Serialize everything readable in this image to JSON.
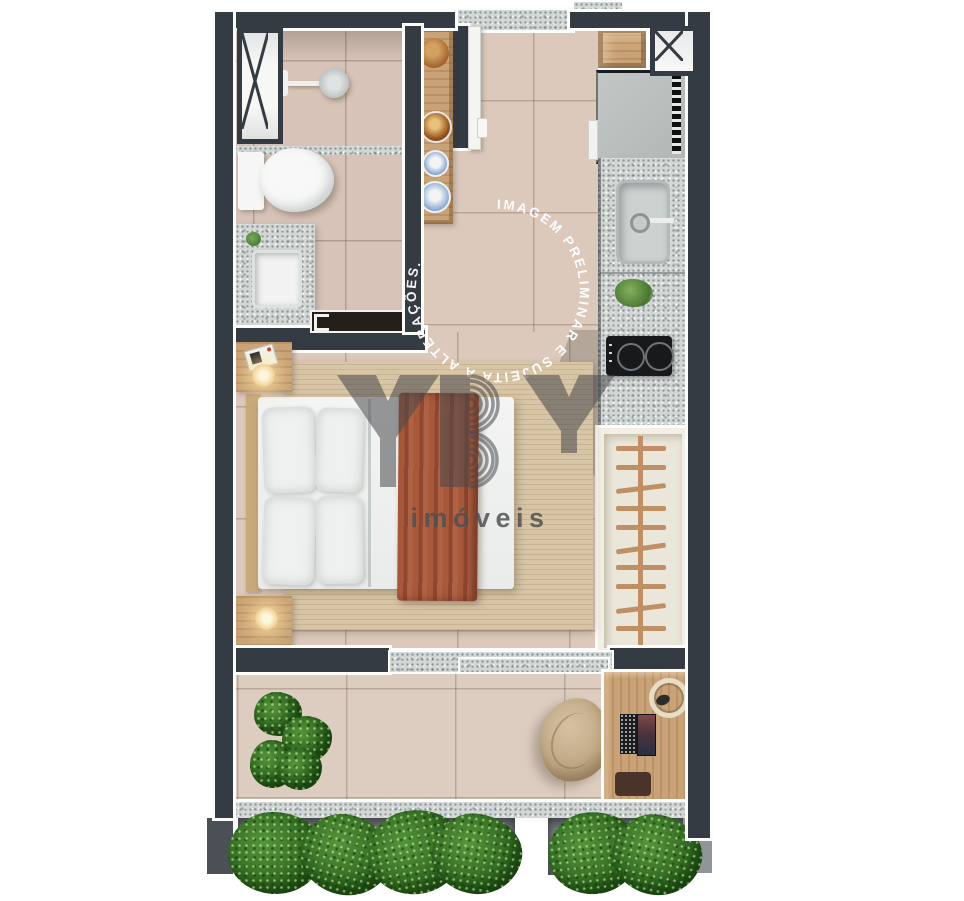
{
  "watermark": {
    "circle_text": "IMAGEM PRELIMINAR E SUJEITA A ALTERAÇÕES.  ",
    "text_color": "#ffffff"
  },
  "logo": {
    "name": "YBY",
    "tagline": "imóveis",
    "color": "#47474b"
  },
  "palette": {
    "wall": "#343b43",
    "wall_trim": "#fcfcfb",
    "floor_living": "#dcc9bc",
    "floor_bathroom": "#d7c3b7",
    "floor_balcony": "#ddcdc0",
    "granite_counter": "#d2d7d6",
    "wood": "#c9a377",
    "wardrobe_interior": "#ebe6da",
    "fridge": "#b9bdbc",
    "cooktop": "#17191b",
    "bed_linen": "#f1f3f2",
    "rug": "#d8c5a6",
    "throw_terracotta": "#a8593c",
    "greenery": "#2d651f",
    "planter_box": "#75797e"
  },
  "furniture_icons": [
    "duct-shaft-x-icon",
    "shower-head-icon",
    "toilet-icon",
    "vanity-sink-icon",
    "decor-shelf-bowls-icon",
    "entry-door-icon",
    "storage-box-icon",
    "fridge-icon",
    "kitchen-sink-icon",
    "herbs-icon",
    "cooktop-icon",
    "wardrobe-hangers-icon",
    "double-bed-icon",
    "pillow-icon",
    "throw-blanket-icon",
    "nightstand-icon",
    "radio-clock-icon",
    "lamp-icon",
    "rug-icon",
    "sliding-door-icon",
    "potted-plant-icon",
    "beanbag-icon",
    "desk-icon",
    "laptop-icon",
    "headphones-icon",
    "desk-pad-icon",
    "hedge-planter-icon"
  ]
}
